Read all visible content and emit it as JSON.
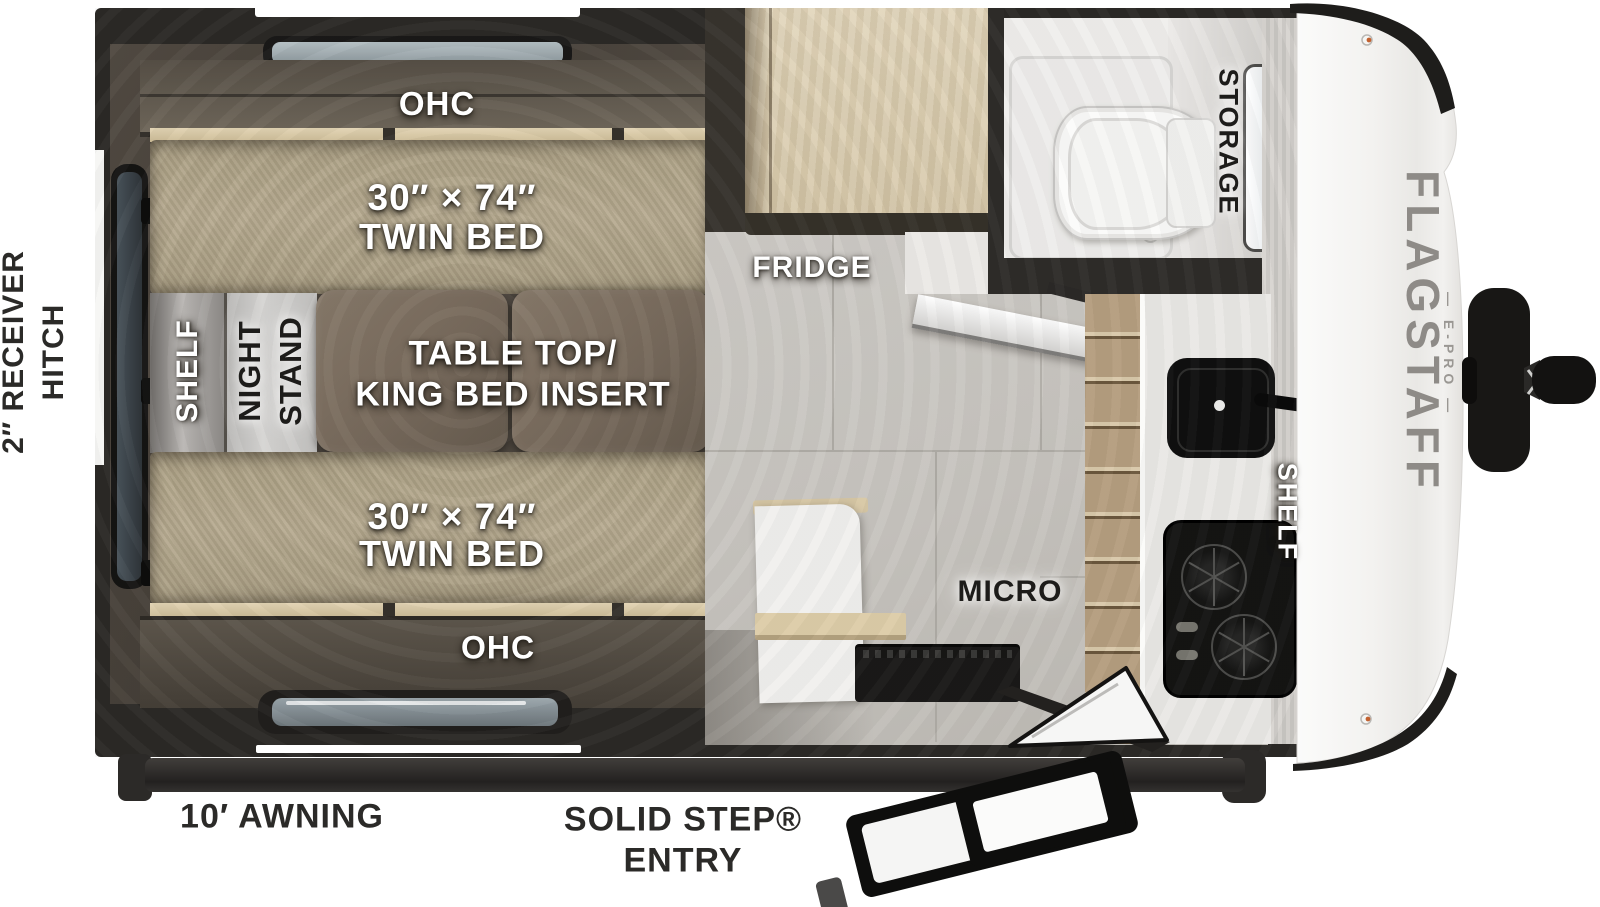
{
  "labels": {
    "receiver": {
      "line1": "2″ RECEIVER",
      "line2": "HITCH"
    },
    "awning": "10′ AWNING",
    "entry": {
      "line1": "SOLID STEP®",
      "line2": "ENTRY"
    },
    "ohc_top": "OHC",
    "ohc_bottom": "OHC",
    "bed_top": {
      "dims": "30″ × 74″",
      "name": "TWIN BED"
    },
    "bed_bottom": {
      "dims": "30″ × 74″",
      "name": "TWIN BED"
    },
    "shelf_left": "SHELF",
    "night_stand": {
      "line1": "NIGHT",
      "line2": "STAND"
    },
    "table": {
      "line1": "TABLE TOP/",
      "line2": "KING BED INSERT"
    },
    "fridge": "FRIDGE",
    "storage": "STORAGE",
    "micro": "MICRO",
    "shelf_right": "SHELF",
    "brand": {
      "name": "FLAGSTAFF",
      "sub": "— E-PRO —"
    }
  },
  "colors": {
    "wall_dark": "#2b2926",
    "bed_tan": "#b2a58a",
    "table_brown": "#7b6e60",
    "wood_light": "#dccfb4",
    "floor_tile": "#c9c6c1",
    "cap_white": "#f4f3f1",
    "label_white": "#ffffff",
    "label_black": "#1d1c1a"
  }
}
